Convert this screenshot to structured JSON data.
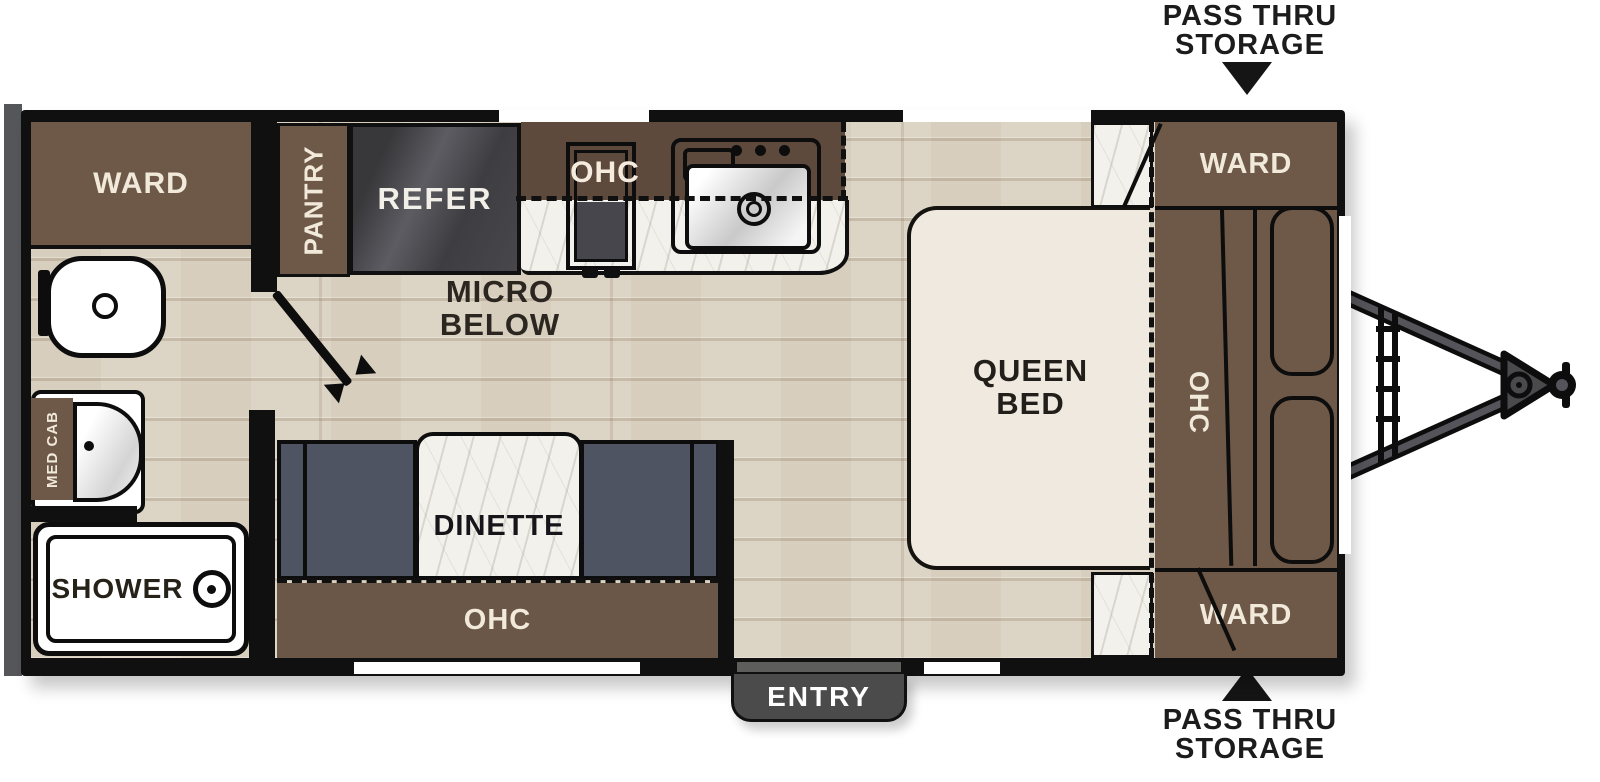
{
  "annotations": {
    "pass_thru_top": {
      "line1": "PASS THRU",
      "line2": "STORAGE"
    },
    "pass_thru_bottom": {
      "line1": "PASS THRU",
      "line2": "STORAGE"
    },
    "micro_below": {
      "line1": "MICRO",
      "line2": "BELOW"
    }
  },
  "bathroom": {
    "ward_label": "WARD",
    "med_cab_label": "MED CAB",
    "shower_label": "SHOWER"
  },
  "kitchen": {
    "pantry_label": "PANTRY",
    "refer_label": "REFER",
    "ohc_label": "OHC"
  },
  "dinette": {
    "table_label": "DINETTE",
    "ohc_label": "OHC"
  },
  "bedroom": {
    "queen_bed": {
      "line1": "QUEEN",
      "line2": "BED"
    },
    "ohc_label": "OHC",
    "ward_top_label": "WARD",
    "ward_bottom_label": "WARD"
  },
  "entry": {
    "label": "ENTRY"
  },
  "colors": {
    "wall": "#101010",
    "cabinet_brown": "#6e5948",
    "kitchen_band_brown": "#5e4a3d",
    "dinette_slate": "#4e5462",
    "floor_wood": "#dcd4c5",
    "marble": "#f3f1ec",
    "bed_cream": "#efe9e0",
    "entry_gray": "#4b4b4b"
  }
}
